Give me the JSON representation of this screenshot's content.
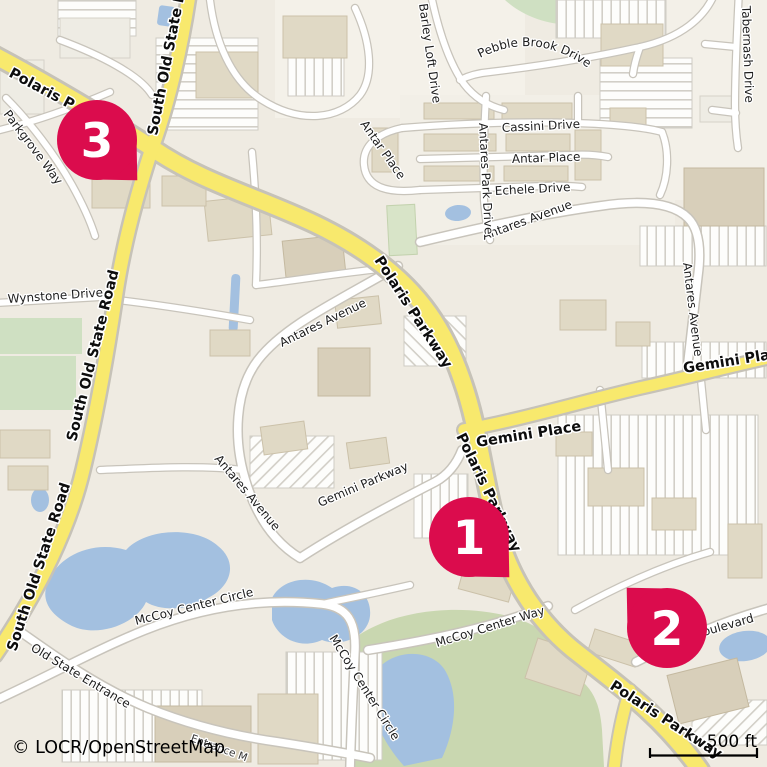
{
  "map": {
    "attribution": "© LOCR/OpenStreetMap",
    "scale": {
      "label": "500 ft"
    },
    "markers": [
      {
        "number": "1"
      },
      {
        "number": "2"
      },
      {
        "number": "3"
      }
    ],
    "colors": {
      "marker": "#db0c4d",
      "major_road": "#f8e96d",
      "minor_road": "#ffffff",
      "water": "#a3c0e0",
      "green": "#cfe0c2",
      "land": "#efebe2"
    },
    "labels": {
      "polaris_top": "Polaris P",
      "polaris_mid": "Polaris Parkway",
      "polaris_low": "Polaris Parkway",
      "polaris_bottom": "Polaris Parkway",
      "s_old_state_top": "South Old State Road",
      "s_old_state_mid": "South Old State Road",
      "s_old_state_bottom": "South Old State Road",
      "gemini_place_e": "Gemini Place",
      "gemini_place_w": "Gemini Place",
      "gemini_parkway": "Gemini Parkway",
      "antares_ave_n": "Antares Avenue",
      "antares_ave_e": "Antares Avenue",
      "antares_ave_w": "Antares Avenue",
      "antares_ave_sw": "Antares Avenue",
      "antares_park_drive": "Antares Park Drive",
      "antar_place_h": "Antar Place",
      "antar_place_d": "Antar Place",
      "cassini_drive": "Cassini Drive",
      "echele_drive": "Echele Drive",
      "barley_loft_drive": "Barley Loft Drive",
      "pebble_brook_drive": "Pebble Brook Drive",
      "tabernash_drive": "Tabernash Drive",
      "wynstone_drive": "Wynstone Drive",
      "parkgrove_way": "Parkgrove Way",
      "mccoy_center_circle_h": "McCoy Center Circle",
      "mccoy_center_circle_v": "McCoy Center Circle",
      "mccoy_center_way": "McCoy Center Way",
      "old_state_entrance": "Old State Entrance",
      "entrance_m": "Entrance M",
      "boulevard": "oulevard"
    }
  }
}
